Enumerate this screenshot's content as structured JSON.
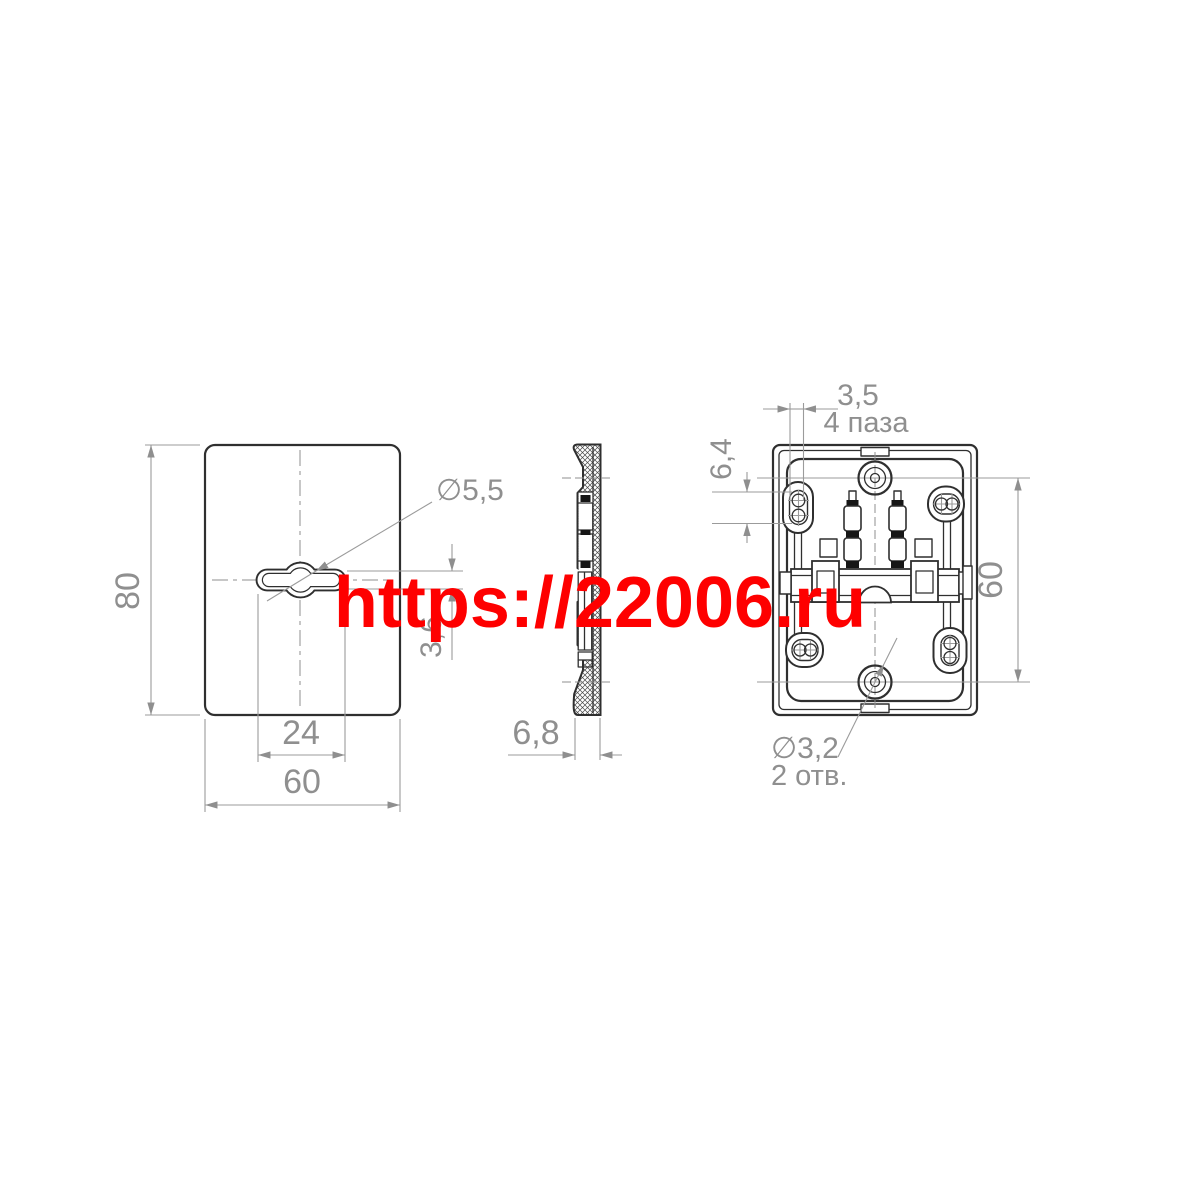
{
  "watermark": {
    "text": "https://22006.ru",
    "color": "#fe0000"
  },
  "front_view": {
    "dim_height": "80",
    "dim_width": "60",
    "dim_slot_span": "24",
    "dim_slot_height": "3,6",
    "label_hole_dia": "∅5,5"
  },
  "side_view": {
    "dim_depth": "6,8"
  },
  "back_view": {
    "dim_slot_width": "3,5",
    "label_slots": "4 паза",
    "dim_slot_length": "6,4",
    "dim_hole_spacing": "60",
    "label_hole_dia": "∅3,2",
    "label_holes": "2 отв."
  },
  "colors": {
    "line": "#2f2f2f",
    "dimension": "#8f8f8f",
    "watermark": "#fe0000"
  }
}
